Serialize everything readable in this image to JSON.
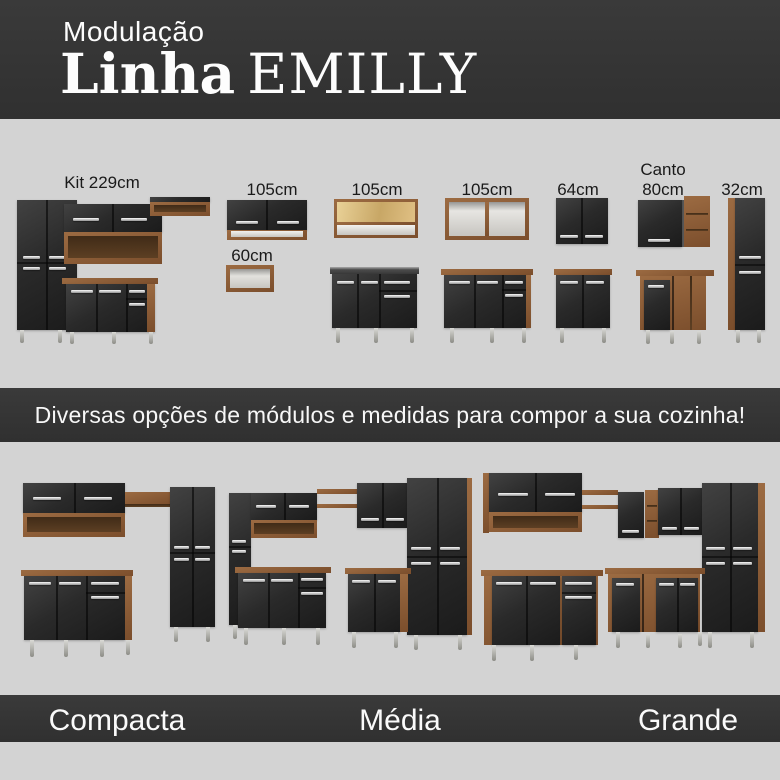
{
  "header": {
    "kicker": "Modulação",
    "brand": "Linha",
    "name": "EMILLY"
  },
  "modules": {
    "items": [
      {
        "label": "Kit 229cm"
      },
      {
        "label": "105cm",
        "sub_label": "60cm"
      },
      {
        "label": "105cm"
      },
      {
        "label": "105cm"
      },
      {
        "label": "64cm"
      },
      {
        "label_line1": "Canto",
        "label_line2": "80cm"
      },
      {
        "label": "32cm"
      }
    ]
  },
  "banner": {
    "text": "Diversas opções de módulos e medidas para compor a sua cozinha!"
  },
  "sizes": {
    "labels": [
      "Compacta",
      "Média",
      "Grande"
    ]
  },
  "colors": {
    "page_background": "#d3d3d3",
    "band_background": "#343434",
    "text_light": "#ffffff",
    "text_dark": "#1a1a1a",
    "wood": "#8a5c38",
    "door_black": "#262626",
    "handle_silver": "#d9d9d9",
    "pine_interior": "#d9bd85"
  }
}
